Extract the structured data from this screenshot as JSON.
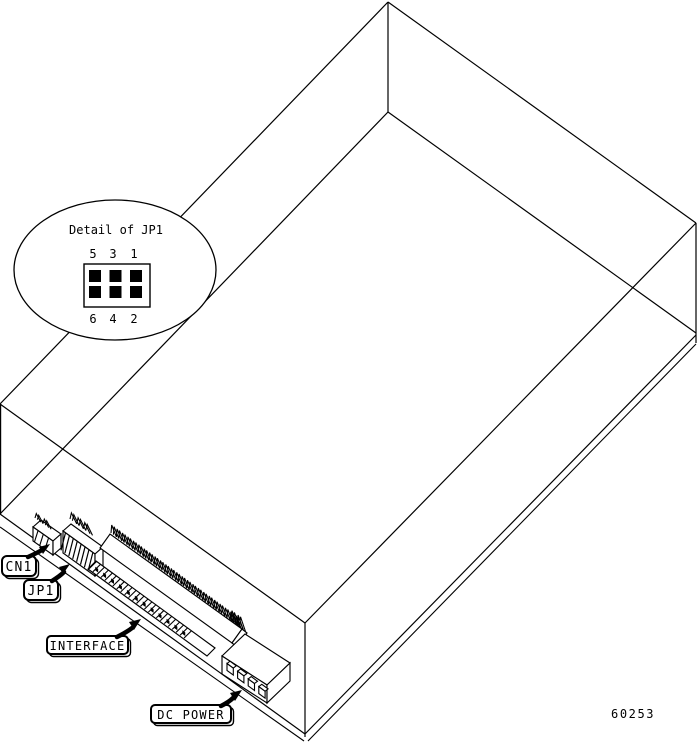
{
  "figure": {
    "background_color": "#ffffff",
    "line_color": "#000000",
    "drawing_number": "60253",
    "detail_callout": {
      "title": "Detail of JP1",
      "top_pin_labels": [
        "5",
        "3",
        "1"
      ],
      "bottom_pin_labels": [
        "6",
        "4",
        "2"
      ],
      "jumper_grid": {
        "rows": 2,
        "cols": 3,
        "filled": [
          [
            true,
            true,
            true
          ],
          [
            true,
            true,
            true
          ]
        ]
      }
    },
    "component_labels": {
      "cn1": "CN1",
      "jp1": "JP1",
      "interface": "INTERFACE",
      "dc_power": "DC POWER"
    }
  }
}
